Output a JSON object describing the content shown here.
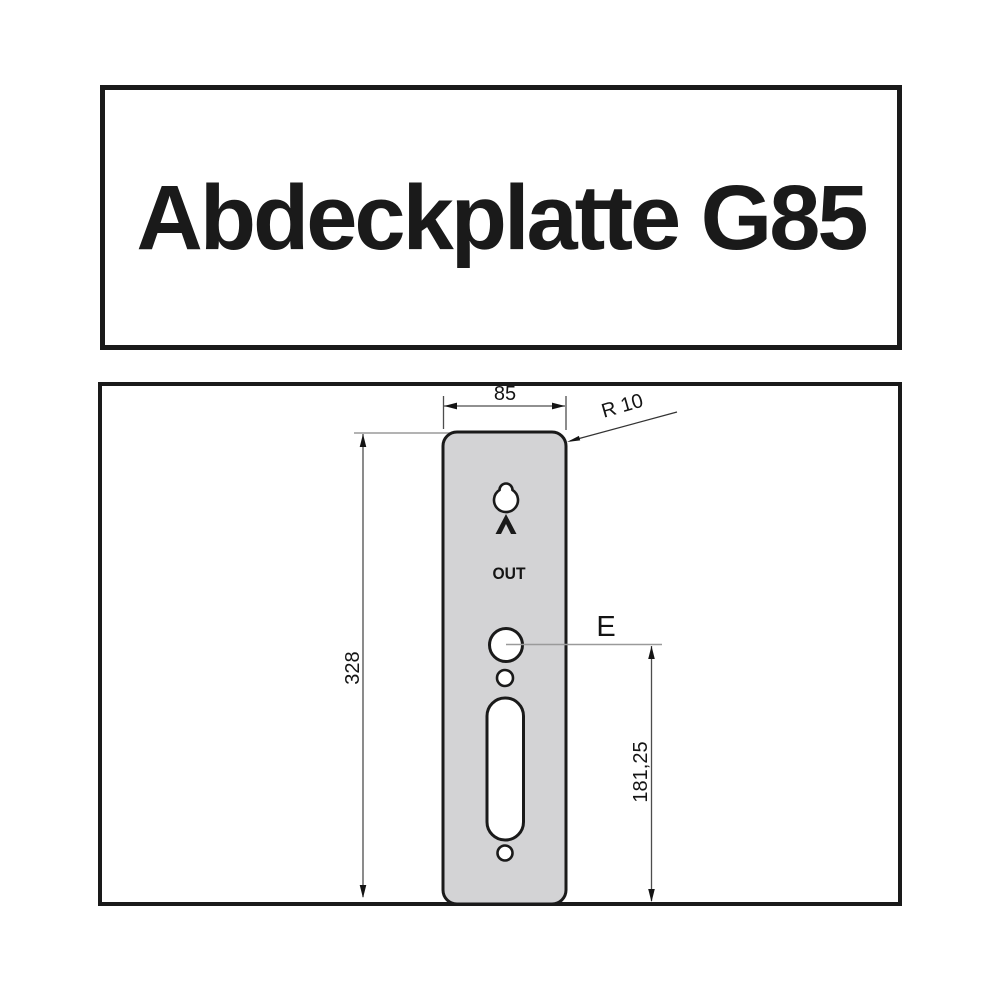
{
  "title": {
    "text": "Abdeckplatte G85"
  },
  "drawing": {
    "labels": {
      "width": "85",
      "radius": "R 10",
      "height": "328",
      "hole": "E",
      "hole_distance": "181,25",
      "out": "OUT"
    },
    "colors": {
      "plate_fill": "#d3d3d5",
      "outline": "#1a1a1a",
      "dim_line": "#4d4d4d",
      "ext_line": "#9a9a9a"
    }
  }
}
